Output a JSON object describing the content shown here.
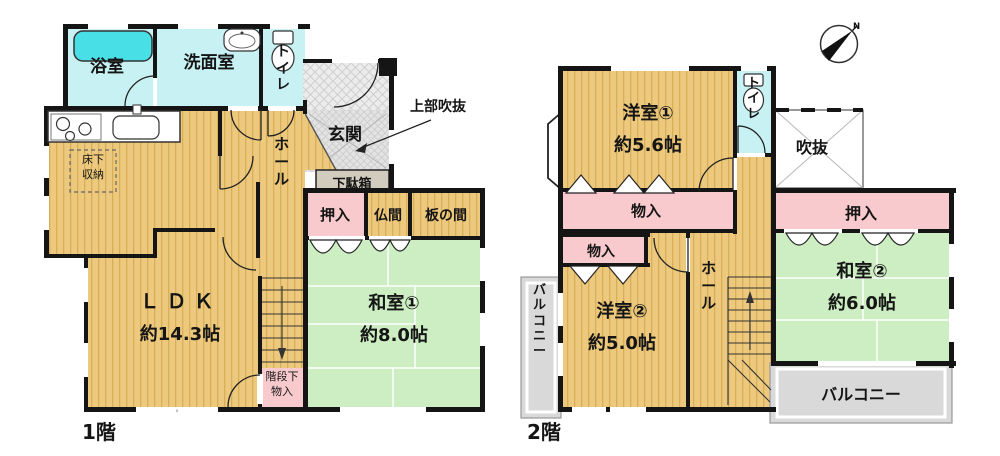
{
  "floor1": {
    "label": "1階",
    "rooms": {
      "bath": "浴室",
      "washroom": "洗面室",
      "toilet": "トイレ",
      "hall": "ホール",
      "genkan": "玄関",
      "genkan_note": "上部吹抜",
      "shoe_cabinet": "下駄箱",
      "underfloor_storage": "床下収納",
      "closet": "押入",
      "butsuma": "仏間",
      "itanoma": "板の間",
      "ldk_name": "ＬＤＫ",
      "ldk_size": "約14.3帖",
      "washitsu_name": "和室①",
      "washitsu_size": "約8.0帖",
      "stair_storage": "階段下物入"
    }
  },
  "floor2": {
    "label": "2階",
    "rooms": {
      "yoshitsu1_name": "洋室①",
      "yoshitsu1_size": "約5.6帖",
      "toilet": "トイレ",
      "void": "吹抜",
      "closet": "押入",
      "washitsu_name": "和室②",
      "washitsu_size": "約6.0帖",
      "balcony_right": "バルコニー",
      "balcony_left": "バルコニー",
      "storage_a": "物入",
      "storage_b": "物入",
      "yoshitsu2_name": "洋室②",
      "yoshitsu2_size": "約5.0帖",
      "hall": "ホール"
    }
  },
  "compass": {
    "north_label": "N"
  },
  "colors": {
    "wall": "#151515",
    "wood_floor": "#ecc97e",
    "wood_stripe": "#d9af55",
    "tatami": "#cdeec3",
    "closet_pink": "#f8cacd",
    "water_cyan": "#c8f1f4",
    "bathtub": "#49dfe7",
    "balcony_gray": "#d9d9d9",
    "entrance_gray": "#e3e3e3",
    "shoe_cabinet": "#d2ccbf"
  }
}
